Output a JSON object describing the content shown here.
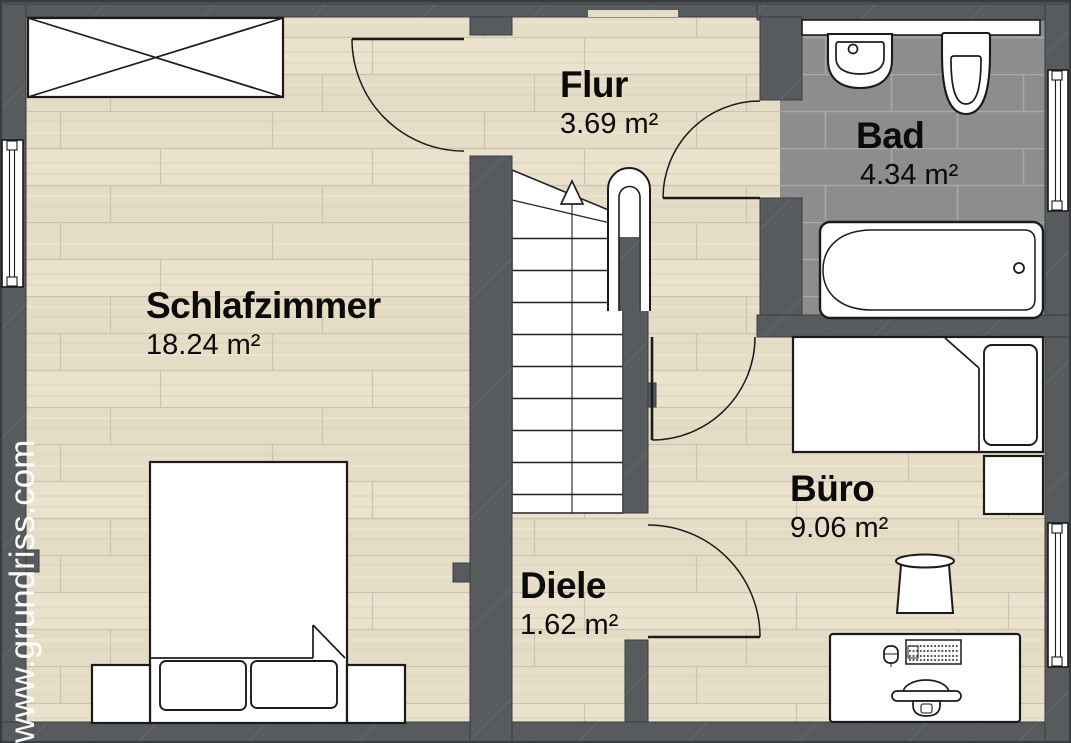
{
  "watermark": {
    "text": "www.grundriss.com"
  },
  "rooms": [
    {
      "name": "Schlafzimmer",
      "area": "18.24 m²"
    },
    {
      "name": "Flur",
      "area": "3.69 m²"
    },
    {
      "name": "Bad",
      "area": "4.34 m²"
    },
    {
      "name": "Büro",
      "area": "9.06 m²"
    },
    {
      "name": "Diele",
      "area": "1.62 m²"
    }
  ],
  "stairs": {
    "arrow_direction": "up",
    "tread_count": 10
  },
  "colors": {
    "wall": "#575b5e",
    "wood_floor": "#e8e0cb",
    "wood_joint": "#c9c3b0",
    "tile_floor": "#8d8d8d",
    "tile_grout": "#a8a8a8",
    "fixture_fill": "#ffffff",
    "outline": "#1b1b1b",
    "watermark_text": "#ffffff"
  },
  "furniture": {
    "schlafzimmer": [
      "wardrobe",
      "double-bed",
      "pillow-left",
      "pillow-right",
      "nightstand-left",
      "nightstand-right"
    ],
    "bad": [
      "washbasin",
      "toilet",
      "bathtub",
      "shelf-window"
    ],
    "buero": [
      "single-bed",
      "pillow",
      "side-table",
      "stool",
      "desk",
      "keyboard",
      "mouse",
      "office-chair"
    ],
    "treppenhaus": [
      "staircase",
      "direction-arrow",
      "walking-line",
      "handrail"
    ]
  },
  "openings": [
    "schlafzimmer-door",
    "bad-door",
    "buero-door",
    "diele-door",
    "window-left",
    "window-bad-top",
    "window-bad-right",
    "window-buero-right"
  ]
}
